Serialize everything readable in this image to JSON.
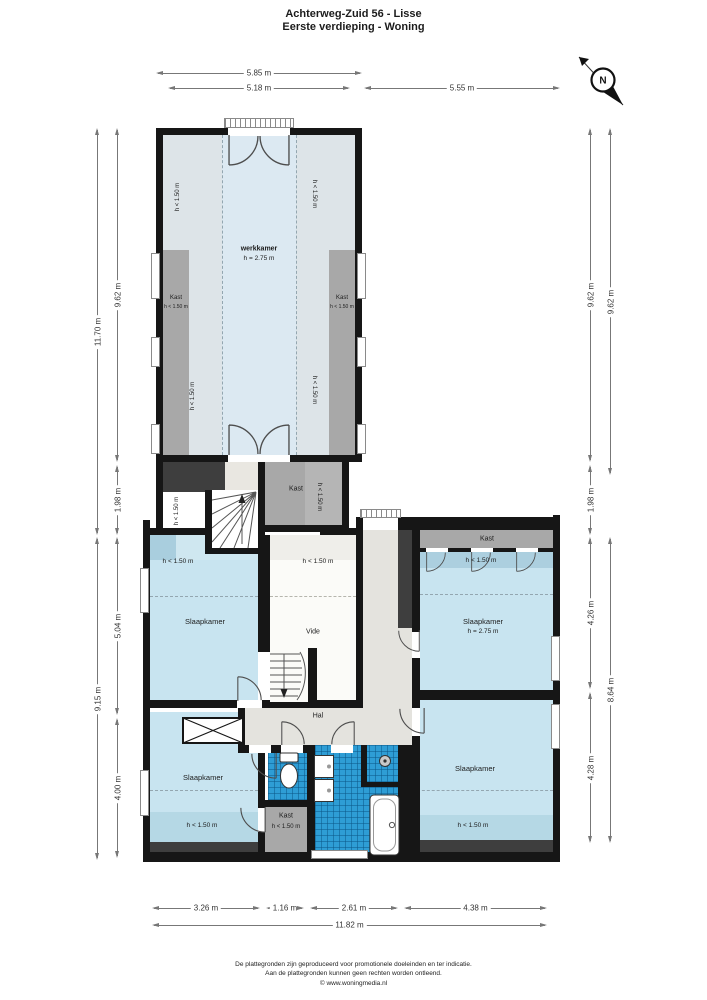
{
  "title": {
    "line1": "Achterweg-Zuid 56 - Lisse",
    "line2": "Eerste verdieping - Woning"
  },
  "compass": {
    "north_label": "N"
  },
  "labels": {
    "werkkamer": "werkkamer",
    "slaapkamer": "Slaapkamer",
    "vide": "Vide",
    "hal": "Hal",
    "kast": "Kast",
    "h_275": "h = 2.75 m",
    "h_150": "h < 1.50 m"
  },
  "dims": {
    "top_wing_outer": "5.85 m",
    "top_wing_inner": "5.18 m",
    "top_right_body": "5.55 m",
    "left_total_upper": "11.70 m",
    "left_wing": "9.62 m",
    "left_mid": "1.98 m",
    "left_body": "9.15 m",
    "left_bed_top": "5.04 m",
    "left_bed_bottom": "4.00 m",
    "right_wing_inner": "9.62 m",
    "right_wing_outer": "9.62 m",
    "right_mid": "1.98 m",
    "right_bed_top": "4.26 m",
    "right_body": "8.64 m",
    "right_bed_bottom": "4.28 m",
    "bottom_seg1": "3.26 m",
    "bottom_seg2": "1.16 m",
    "bottom_seg3": "2.61 m",
    "bottom_seg4": "4.38 m",
    "bottom_total": "11.82 m"
  },
  "footer": {
    "line1": "De plattegronden zijn geproduceerd voor promotionele doeleinden en ter indicatie.",
    "line2": "Aan de plattegronden kunnen geen rechten worden ontleend.",
    "line3": "© www.woningmedia.nl"
  },
  "colors": {
    "wall": "#161616",
    "room_blue": "#c8e4f0",
    "low_strip_blue": "#b5d8e5",
    "werkkamer_blue": "#dce9f2",
    "tile_blue": "#2e9dd5",
    "closet_gray": "#a8a8a8",
    "hall_gray": "#e4e3de",
    "dark_gray": "#3e3e3e"
  }
}
